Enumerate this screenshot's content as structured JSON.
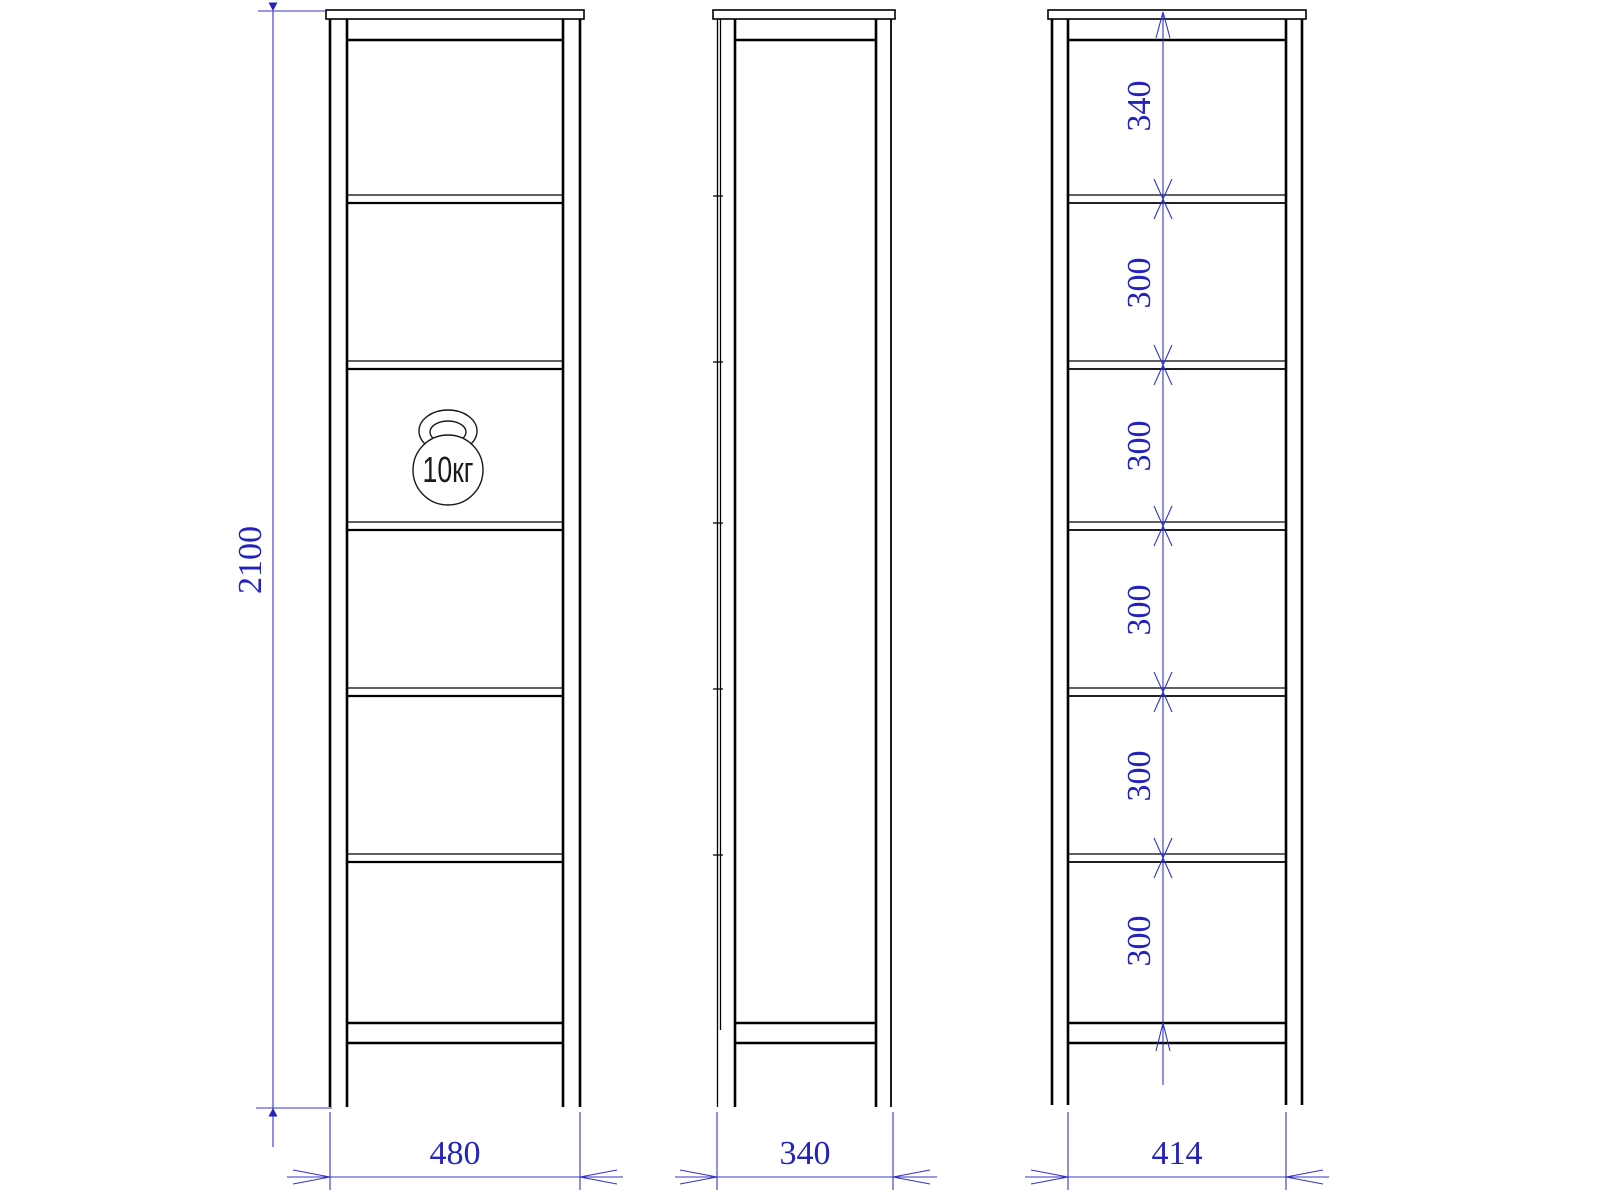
{
  "drawing": {
    "type": "furniture three-view technical drawing",
    "subject": "tall open shelf unit / bookcase",
    "colors": {
      "object_lines": "#000000",
      "dimension_lines": "#3434c8",
      "dimension_text": "#2323bb",
      "background": "#ffffff"
    },
    "dimensions": {
      "overall_height": "2100",
      "front_width": "480",
      "side_depth": "340",
      "back_inner_width": "414",
      "bay_spacings": [
        "340",
        "300",
        "300",
        "300",
        "300",
        "300"
      ]
    },
    "annotations": {
      "shelf_load": "10кг"
    }
  }
}
